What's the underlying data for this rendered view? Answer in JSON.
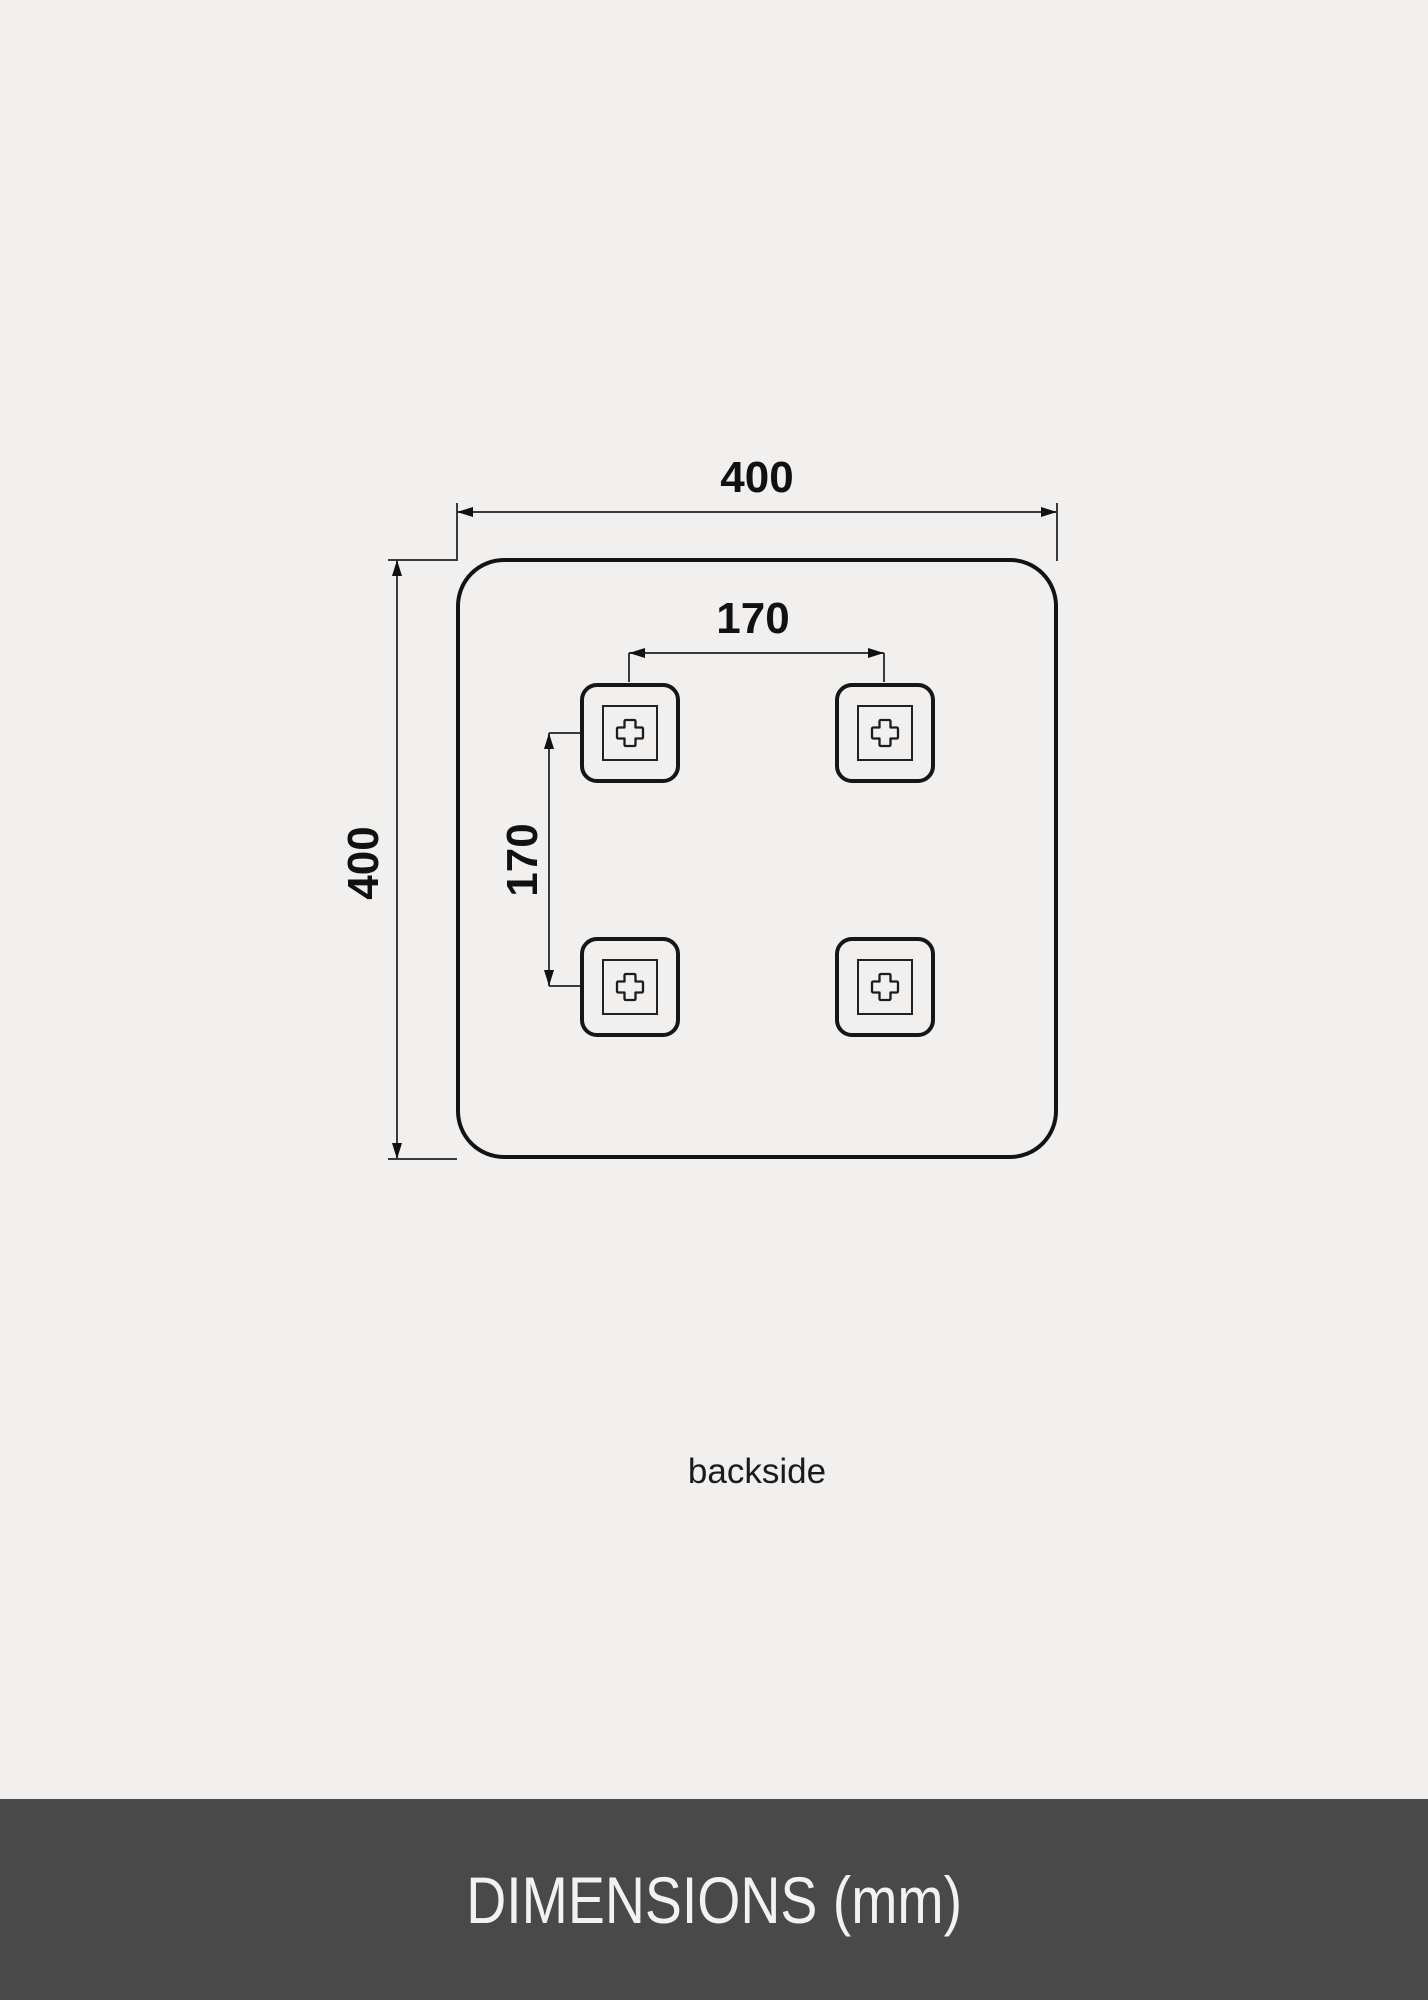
{
  "page": {
    "background_color": "#f1f0ef",
    "line_color": "#131313"
  },
  "drawing": {
    "view_label": "backside",
    "outer_width_mm": "400",
    "outer_height_mm": "400",
    "bracket_spacing_horizontal_mm": "170",
    "bracket_spacing_vertical_mm": "170",
    "bracket_count": 4,
    "bracket_icon": "plus-icon"
  },
  "footer": {
    "title": "DIMENSIONS (mm)",
    "background_color": "#494949",
    "text_color": "#f4f2f0"
  }
}
